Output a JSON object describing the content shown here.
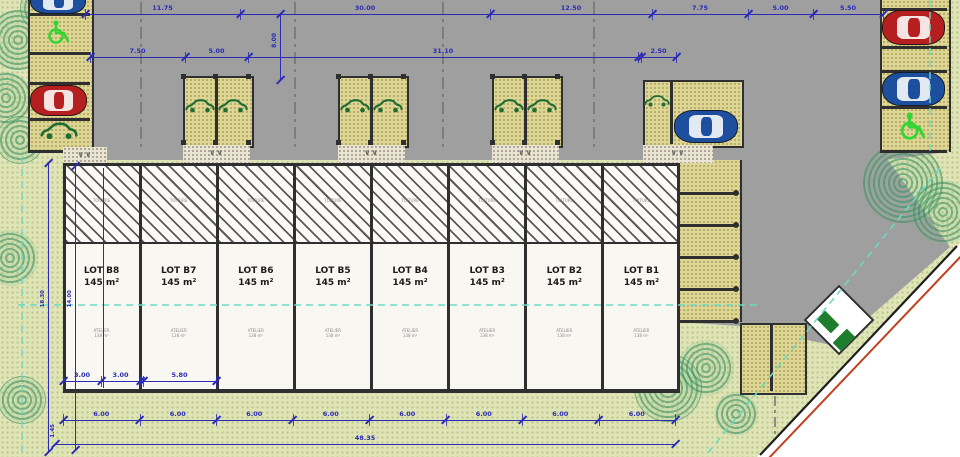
{
  "plan": {
    "lots": [
      {
        "label": "LOT B8",
        "area": "145 m²"
      },
      {
        "label": "LOT B7",
        "area": "145 m²"
      },
      {
        "label": "LOT B6",
        "area": "145 m²"
      },
      {
        "label": "LOT B5",
        "area": "145 m²"
      },
      {
        "label": "LOT B4",
        "area": "145 m²"
      },
      {
        "label": "LOT B3",
        "area": "145 m²"
      },
      {
        "label": "LOT B2",
        "area": "145 m²"
      },
      {
        "label": "LOT B1",
        "area": "145 m²"
      }
    ],
    "lot_fine_print": {
      "roof_text": "TOITURE",
      "floor_line1": "ATELIER",
      "floor_line2": "138 m²"
    },
    "dimensions": {
      "top_row1": {
        "y": 14,
        "segments": [
          {
            "from": 85,
            "to": 240,
            "label": "11.75"
          },
          {
            "from": 240,
            "to": 490,
            "label": "30.00"
          },
          {
            "from": 490,
            "to": 652,
            "label": "12.50"
          },
          {
            "from": 652,
            "to": 748,
            "label": "7.75"
          },
          {
            "from": 748,
            "to": 813,
            "label": "5.00"
          },
          {
            "from": 813,
            "to": 883,
            "label": "5.50"
          }
        ]
      },
      "top_row2": {
        "y": 57,
        "segments": [
          {
            "from": 90,
            "to": 185,
            "label": "7.50"
          },
          {
            "from": 185,
            "to": 248,
            "label": "5.00"
          },
          {
            "from": 248,
            "to": 638,
            "label": "31.10"
          }
        ]
      },
      "dim_2_50": {
        "y": 57,
        "from": 641,
        "to": 676,
        "label": "2.50"
      },
      "dim_8_00": {
        "x": 280,
        "from": 14,
        "to": 80,
        "label": "8.00"
      },
      "bottom_row": {
        "y": 420,
        "start": 63,
        "end": 675,
        "count": 8,
        "label": "6.00"
      },
      "total_row": {
        "y": 444,
        "from": 55,
        "to": 675,
        "label": "48.35"
      },
      "left_v1": {
        "x": 48,
        "from": 163,
        "to": 452,
        "label": "18.30"
      },
      "left_v2": {
        "x": 75,
        "from": 166,
        "to": 450,
        "label": "14.00"
      },
      "corner_small": {
        "label": "1.45"
      },
      "lot_inner": {
        "y": 381,
        "segments": [
          {
            "from": 63,
            "to": 101,
            "label": "3.00"
          },
          {
            "from": 101,
            "to": 140,
            "label": "3.00"
          },
          {
            "from": 143,
            "to": 216,
            "label": "5.80"
          }
        ]
      }
    },
    "symbols": {
      "accessible_parking": "wheelchair-icon",
      "ev_space": "green-car-outline-icon",
      "apron_mark": "chevron-marks"
    },
    "colors": {
      "road": "#9f9f9f",
      "grass": "#dfe5b6",
      "parking": "#ddd695",
      "lot_fill": "#f8f7f2",
      "dimension": "#2b2bb4",
      "cyan_line": "#6fd8c4",
      "tree_green": "#2e8255",
      "red_car": "#b51f1f",
      "blue_car": "#1d4f9e",
      "accessible_green": "#35d435",
      "ev_green": "#1e6b33",
      "boundary_red": "#c2401e",
      "kiosk_green": "#1f7d2e",
      "wall": "#2f2f2f"
    }
  }
}
